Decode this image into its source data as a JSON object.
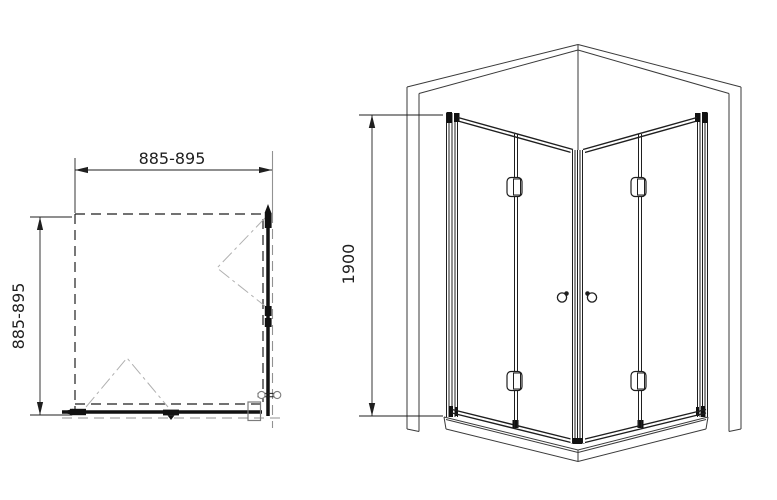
{
  "plan_view": {
    "width_label": "885-895",
    "depth_label": "885-895"
  },
  "perspective_view": {
    "height_label": "1900"
  },
  "colors": {
    "line": "#1f1f1f",
    "secondary_line": "#929292",
    "swing_line": "#b0b0b0",
    "background": "#ffffff"
  }
}
